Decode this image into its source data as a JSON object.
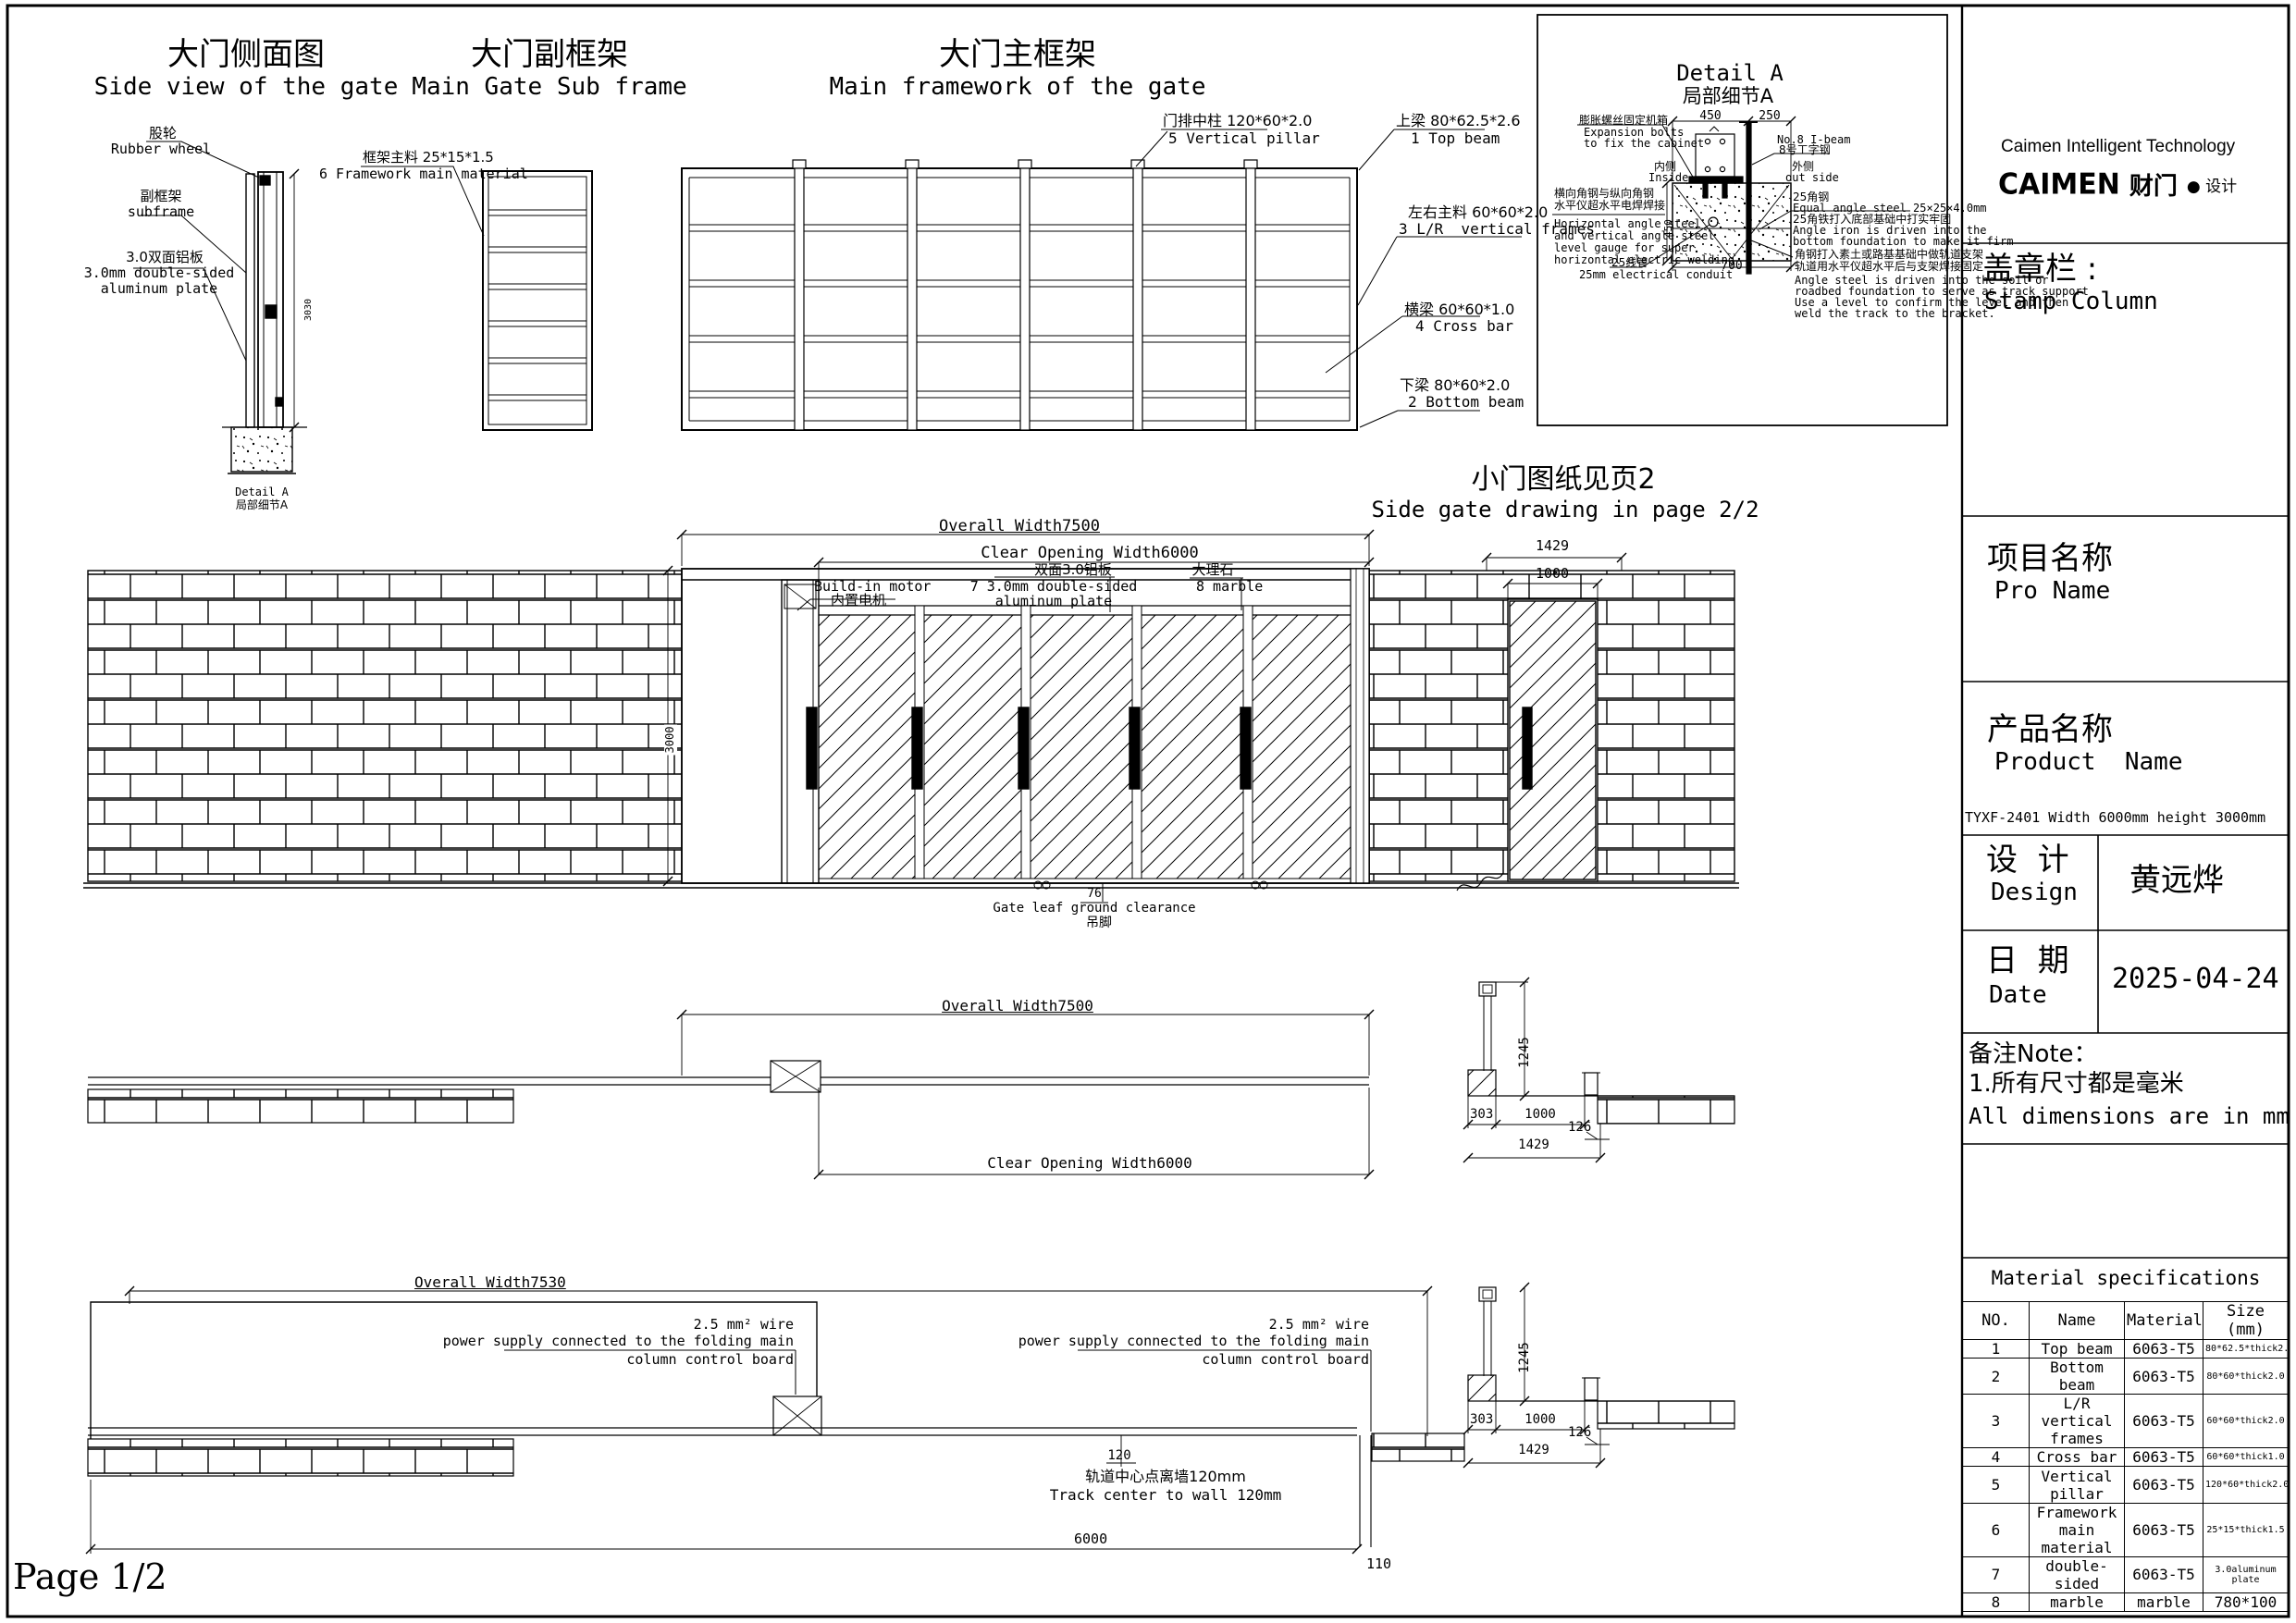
{
  "page": {
    "label": "Page 1/2"
  },
  "dims": {
    "overall_7500": "Overall Width7500",
    "clear_6000": "Clear Opening Width6000",
    "overall_7530": "Overall Width7530",
    "d1429": "1429",
    "d1000": "1000",
    "d1245": "1245",
    "d303": "303",
    "d126": "126",
    "d120": "120",
    "d6000": "6000",
    "d110": "110",
    "d3000": "3000",
    "d3030": "3030",
    "d450": "450",
    "d250": "250",
    "d700": "700",
    "d76": "76"
  },
  "side_view": {
    "title_cn": "大门侧面图",
    "title_en": "Side view of the gate",
    "rubber_cn": "股轮",
    "rubber_en": "Rubber wheel",
    "subframe_cn": "副框架",
    "subframe_en": "subframe",
    "alum_cn": "3.0双面铝板",
    "alum_en1": "3.0mm double-sided",
    "alum_en2": "aluminum plate",
    "detail_ref_en": "Detail A",
    "detail_ref_cn": "局部细节A"
  },
  "sub_frame": {
    "title_cn": "大门副框架",
    "title_en": "Main Gate Sub frame",
    "callout_cn": "框架主料 25*15*1.5",
    "callout_en": "6 Framework main material"
  },
  "main_frame": {
    "title_cn": "大门主框架",
    "title_en": "Main framework of the gate",
    "pillar_cn": "门排中柱 120*60*2.0",
    "pillar_en": "5 Vertical pillar",
    "top_cn": "上梁 80*62.5*2.6",
    "top_en": "1 Top beam",
    "lr_cn": "左右主料 60*60*2.0",
    "lr_en": "3 L/R  vertical frames",
    "cross_cn": "横梁 60*60*1.0",
    "cross_en": "4 Cross bar",
    "bottom_cn": "下梁 80*60*2.0",
    "bottom_en": "2 Bottom beam"
  },
  "detail_a": {
    "title_en": "Detail A",
    "title_cn": "局部细节A",
    "expansion_cn": "膨胀螺丝固定机箱",
    "expansion_en1": "Expansion bolts",
    "expansion_en2": "to fix the cabinet",
    "ibeam_en": "No.8 I-beam",
    "ibeam_cn": "8号工字钢",
    "inside_cn": "内侧",
    "inside_en": "Inside",
    "outside_cn": "外侧",
    "outside_en": "out side",
    "left_cn1": "横向角钢与纵向角钢",
    "left_cn2": "水平仪超水平电焊焊接",
    "left_en1": "Horizontal angle steel",
    "left_en2": "and vertical angle steel",
    "left_en3": "level gauge for super",
    "left_en4": "horizontal electric welding",
    "conduit_cn": "25线管",
    "conduit_en": "25mm electrical conduit",
    "angle_cn": "25角钢",
    "angle_en": "Equal angle steel 25×25×4.0mm",
    "angle2_cn": "25角铁打入底部基础中打实牢固",
    "angle2_en1": "Angle iron is driven into the",
    "angle2_en2": "bottom foundation to make it firm",
    "track_cn1": "角钢打入素土或路基基础中做轨道支架",
    "track_cn2": "轨道用水平仪超水平后与支架焊接固定",
    "track_en1": "Angle steel is driven into the soil or",
    "track_en2": "roadbed foundation to serve as track support",
    "track_en3": "Use a level to confirm the level and then",
    "track_en4": "weld the track to the bracket."
  },
  "side_gate_note": {
    "cn": "小门图纸见页2",
    "en": "Side gate drawing in page 2/2"
  },
  "elevation": {
    "motor_en": "Build-in motor",
    "motor_cn": "内置电机",
    "alum_cn": "双面3.0铝板",
    "alum_en1": "7 3.0mm double-sided",
    "alum_en2": "aluminum plate",
    "marble_cn": "大理石",
    "marble_en": "8 marble",
    "clearance_en": "Gate leaf ground clearance",
    "clearance_cn": "吊脚"
  },
  "plan_view": {
    "wire_l1": "2.5 mm² wire",
    "wire_l2": "power supply connected to the folding main",
    "wire_l3": "column control board",
    "track_cn": "轨道中心点离墙120mm",
    "track_en": "Track center to wall 120mm"
  },
  "title_block": {
    "company": "Caimen Intelligent Technology",
    "logo_caimen": "CAIMEN",
    "logo_cn": "财门",
    "logo_tail": "● 设计",
    "stamp_cn": "盖章栏 :",
    "stamp_en": "Stamp Column",
    "pro_cn": "项目名称",
    "pro_en": "Pro Name",
    "product_cn": "产品名称",
    "product_en": "Product  Name",
    "product_spec": "TYXF-2401 Width 6000mm height 3000mm",
    "design_cn": "设  计",
    "design_en": "Design",
    "designer": "黄远烨",
    "date_cn": "日  期",
    "date_en": "Date",
    "date_value": "2025-04-24",
    "note_title": "备注Note：",
    "note_1": "1.所有尺寸都是毫米",
    "note_2": "All dimensions are in mm"
  },
  "material_table": {
    "title": "Material specifications",
    "headers": [
      "NO.",
      "Name",
      "Material",
      "Size (mm)"
    ],
    "rows": [
      [
        "1",
        "Top beam",
        "6063-T5",
        "80*62.5*thick2.6"
      ],
      [
        "2",
        "Bottom beam",
        "6063-T5",
        "80*60*thick2.0"
      ],
      [
        "3",
        "L/R vertical frames",
        "6063-T5",
        "60*60*thick2.0"
      ],
      [
        "4",
        "Cross bar",
        "6063-T5",
        "60*60*thick1.0"
      ],
      [
        "5",
        "Vertical pillar",
        "6063-T5",
        "120*60*thick2.0"
      ],
      [
        "6",
        "Framework main material",
        "6063-T5",
        "25*15*thick1.5"
      ],
      [
        "7",
        "double-sided",
        "6063-T5",
        "3.0aluminum plate"
      ],
      [
        "8",
        "marble",
        "marble",
        "780*100"
      ]
    ]
  }
}
